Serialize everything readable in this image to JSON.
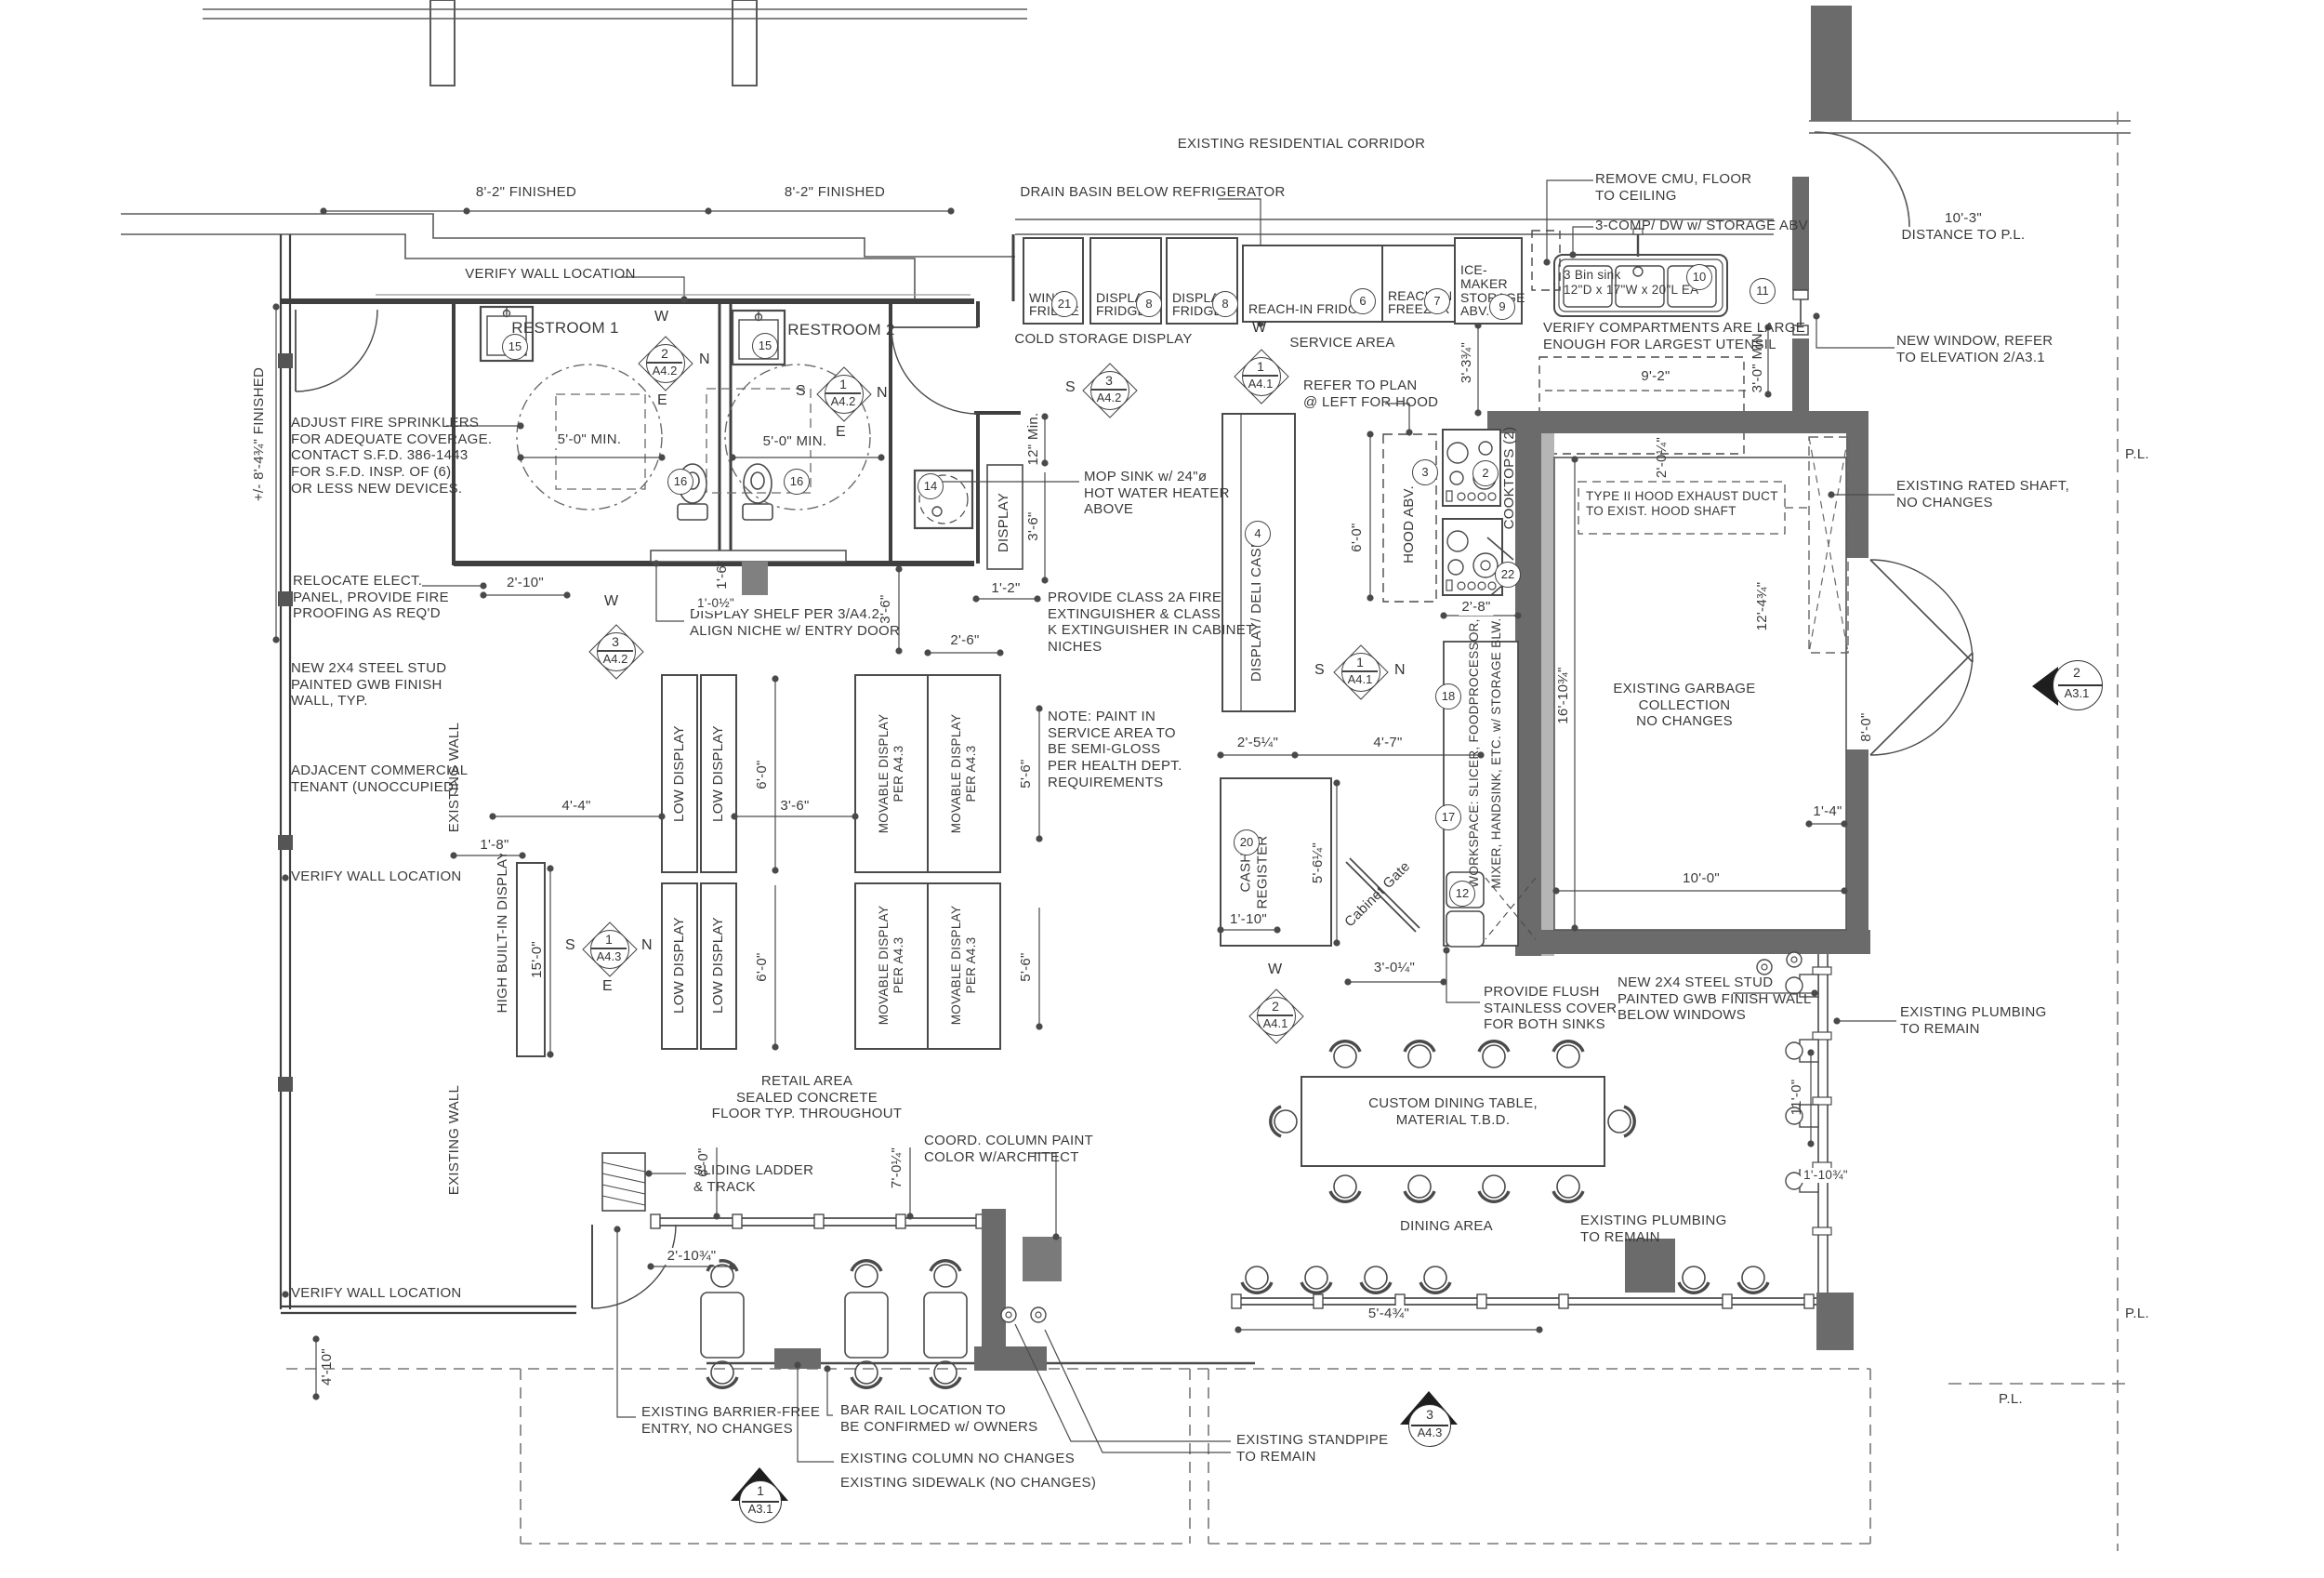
{
  "areas": {
    "corridor": "EXISTING RESIDENTIAL CORRIDOR",
    "restroom1": "RESTROOM 1",
    "restroom2": "RESTROOM 2",
    "cold_storage": "COLD STORAGE DISPLAY",
    "service_area": "SERVICE AREA",
    "retail": "RETAIL AREA\nSEALED CONCRETE\nFLOOR TYP. THROUGHOUT",
    "dining": "DINING AREA",
    "garbage": "EXISTING GARBAGE\nCOLLECTION\nNO CHANGES",
    "adjacent": "ADJACENT COMMERCIAL\nTENANT (UNOCCUPIED)"
  },
  "equipment": {
    "wine_fridge": "WINE\nFRIDGE",
    "display_fridge": "DISPLAY\nFRIDGE",
    "reach_in_fridge": "REACH-IN FRIDGE",
    "reach_in_freezer": "REACH-IN\nFREEZER",
    "ice_maker": "ICE-MAKER\nSTORAGE\nABV.",
    "bin_sink": "3 Bin sink\n12\"D x 17\"W x 20\"L EA",
    "deli_case": "DISPLAY/ DELI CASE",
    "hood": "HOOD ABV.",
    "cooktops": "COOKTOPS (2)",
    "workspace1": "WORKSPACE: SLICER, FOODPROCESSOR,",
    "workspace2": "MIXER, HANDSINK, ETC. w/ STORAGE BLW.",
    "cash": "CASH\nREGISTER",
    "gate": "Cabinet Gate",
    "low_display": "LOW DISPLAY",
    "movable": "MOVABLE DISPLAY\nPER A4.3",
    "high_display": "HIGH BUILT-IN DISPLAY",
    "display": "DISPLAY",
    "table": "CUSTOM DINING TABLE,\nMATERIAL T.B.D."
  },
  "notes": {
    "drain": "DRAIN BASIN BELOW REFRIGERATOR",
    "cmu": "REMOVE CMU, FLOOR\nTO CEILING",
    "comp3": "3-COMP/ DW w/ STORAGE ABV",
    "verify_comp": "VERIFY COMPARTMENTS ARE LARGE\nENOUGH FOR LARGEST UTENSIL",
    "window": "NEW WINDOW, REFER\nTO ELEVATION 2/A3.1",
    "vwall": "VERIFY WALL LOCATION",
    "sprinklers": "ADJUST FIRE SPRINKLERS\nFOR ADEQUATE COVERAGE.\nCONTACT S.F.D. 386-1443\nFOR S.F.D. INSP. OF (6)\nOR LESS NEW DEVICES.",
    "relocate": "RELOCATE ELECT.\nPANEL, PROVIDE FIRE\nPROOFING AS REQ'D",
    "stud": "NEW 2X4 STEEL STUD\nPAINTED GWB FINISH\nWALL, TYP.",
    "shelf": "DISPLAY SHELF PER 3/A4.2\nALIGN NICHE w/ ENTRY DOOR",
    "mop": "MOP SINK w/ 24\"ø\nHOT WATER HEATER\nABOVE",
    "class2a": "PROVIDE CLASS 2A FIRE\nEXTINGUISHER & CLASS\nK EXTINGUISHER IN CABINET\nNICHES",
    "paint": "NOTE: PAINT IN\nSERVICE AREA TO\nBE SEMI-GLOSS\nPER HEALTH DEPT.\nREQUIREMENTS",
    "hood_ref": "REFER TO PLAN\n@ LEFT FOR HOOD",
    "duct": "TYPE II HOOD EXHAUST DUCT\nTO EXIST. HOOD SHAFT",
    "shaft": "EXISTING RATED SHAFT,\nNO CHANGES",
    "flush": "PROVIDE FLUSH\nSTAINLESS COVER\nFOR BOTH SINKS",
    "stud2": "NEW 2X4 STEEL STUD\nPAINTED GWB FINISH WALL\nBELOW WINDOWS",
    "plumb": "EXISTING PLUMBING\nTO REMAIN",
    "coord": "COORD. COLUMN PAINT\nCOLOR W/ARCHITECT",
    "ladder": "SLIDING LADDER\n& TRACK",
    "barrier": "EXISTING BARRIER-FREE\nENTRY, NO CHANGES",
    "rail": "BAR RAIL LOCATION TO\nBE CONFIRMED w/ OWNERS",
    "column": "EXISTING COLUMN NO CHANGES",
    "sidewalk": "EXISTING SIDEWALK (NO CHANGES)",
    "standpipe": "EXISTING STANDPIPE\nTO REMAIN",
    "exwall": "EXISTING WALL",
    "distpl": "10'-3\"\nDISTANCE TO P.L."
  },
  "dims": {
    "d8_2": "8'-2\" FINISHED",
    "d8_4": "+/- 8'-4¾\" FINISHED",
    "d5_0": "5'-0\" MIN.",
    "d12": "12\" Min.",
    "d3_6": "3'-6\"",
    "d1_2": "1'-2\"",
    "d2_6": "2'-6\"",
    "d2_10": "2'-10\"",
    "d9_2": "9'-2\"",
    "d3_0m": "3'-0\" MIN.",
    "d3_3": "3'-3¾\"",
    "d6_0": "6'-0\"",
    "d2_8": "2'-8\"",
    "d2_0": "2'-0¼\"",
    "d12_4": "12'-4¾\"",
    "d16_10": "16'-10¾\"",
    "d8_0": "8'-0\"",
    "d1_4": "1'-4\"",
    "d10_0": "10'-0\"",
    "d2_5": "2'-5¼\"",
    "d4_7": "4'-7\"",
    "d5_6q": "5'-6¼\"",
    "d1_10": "1'-10\"",
    "d1_6": "1'-6\"",
    "d1_0h": "1'-0½\"",
    "d3_0q": "3'-0¼\"",
    "d4_4": "4'-4\"",
    "d1_8": "1'-8\"",
    "d15_0": "15'-0\"",
    "d5_6": "5'-6\"",
    "d2_10q": "2'-10¾\"",
    "d7_0q": "7'-0¼\"",
    "d11_0": "11'-0\"",
    "d1_10q": "1'-10¾\"",
    "d5_4q": "5'-4¾\"",
    "d4_10": "4'-10\""
  },
  "markers": {
    "m2a42": {
      "n": "2",
      "s": "A4.2"
    },
    "m1a42": {
      "n": "1",
      "s": "A4.2"
    },
    "m3a42": {
      "n": "3",
      "s": "A4.2"
    },
    "m1a41": {
      "n": "1",
      "s": "A4.1"
    },
    "m1a43": {
      "n": "1",
      "s": "A4.3"
    },
    "m2a41": {
      "n": "2",
      "s": "A4.1"
    },
    "m1a31": {
      "n": "1",
      "s": "A3.1"
    },
    "m3a43": {
      "n": "3",
      "s": "A4.3"
    },
    "m2a31": {
      "n": "2",
      "s": "A3.1"
    }
  },
  "compass": {
    "n": "N",
    "s": "S",
    "e": "E",
    "w": "W"
  },
  "circles": {
    "n2": "2",
    "n3": "3",
    "n4": "4",
    "n6": "6",
    "n7": "7",
    "n8": "8",
    "n9": "9",
    "n10": "10",
    "n11": "11",
    "n12": "12",
    "n14": "14",
    "n15": "15",
    "n16": "16",
    "n17": "17",
    "n18": "18",
    "n20": "20",
    "n21": "21",
    "n22": "22"
  },
  "pl": "P.L."
}
